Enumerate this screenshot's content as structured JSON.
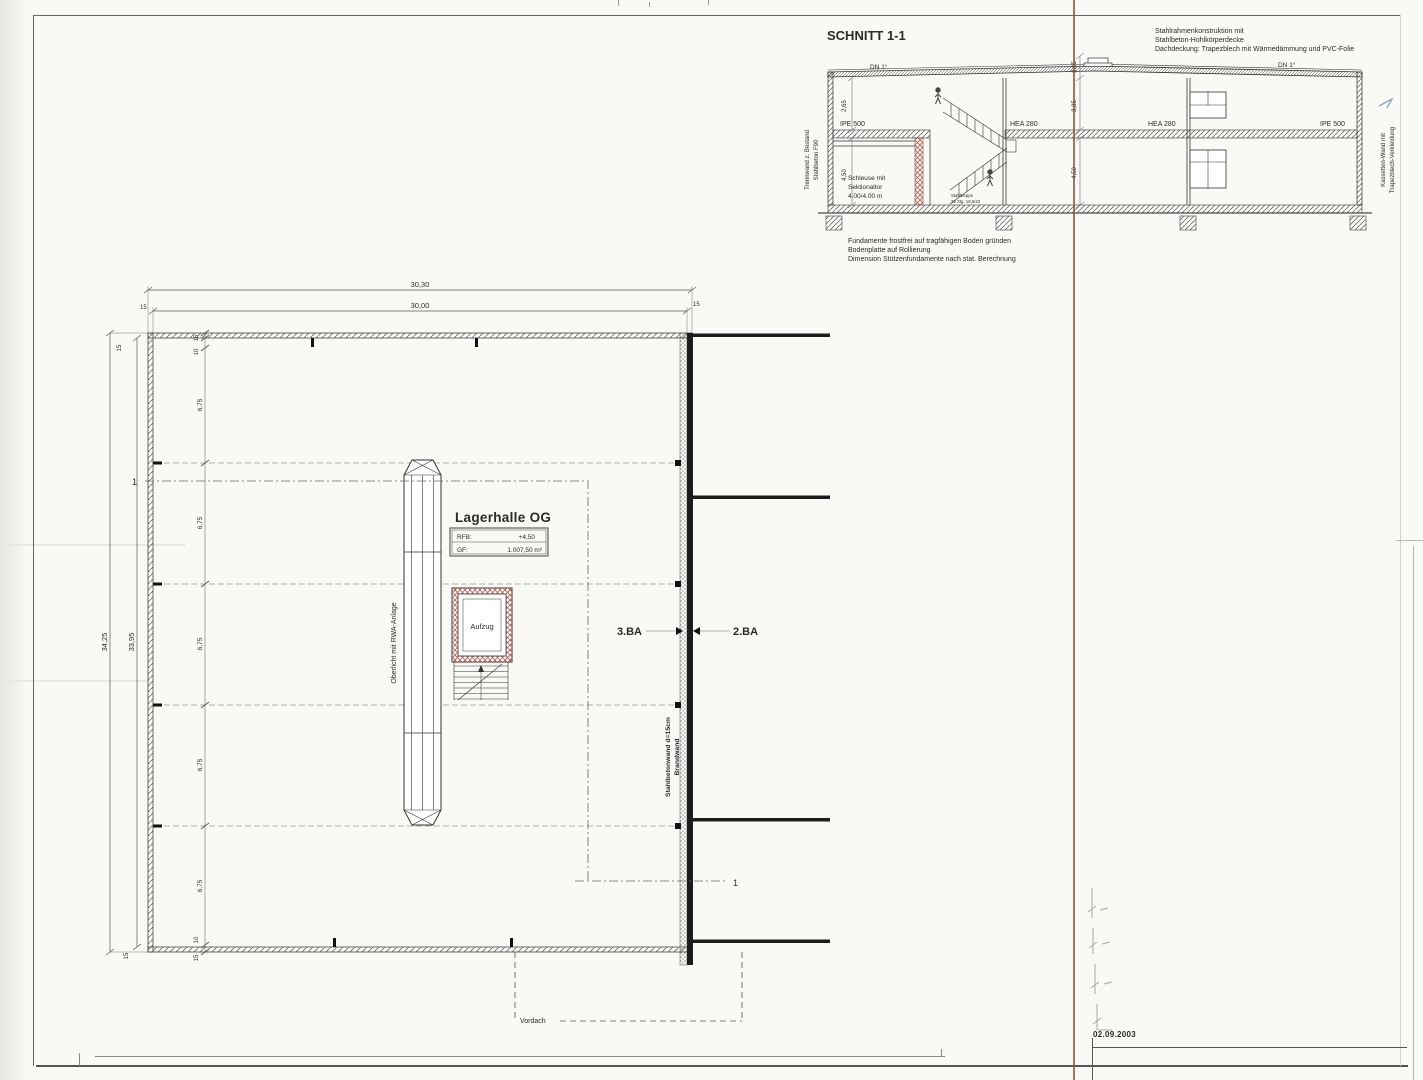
{
  "section": {
    "title": "SCHNITT 1-1",
    "notes_top": {
      "n1": "Stahlrahmenkonstruktion mit",
      "n2": "Stahlbeton-Hohlkörperdecke",
      "n3": "Dachdeckung:  Trapezblech mit Wärmedämmung und PVC-Folie"
    },
    "notes_bottom": {
      "n1": "Fundamente frostfrei auf tragfähigen Boden gründen",
      "n2": "Bodenplatte auf Rollierung",
      "n3": "Dimension Stützenfundamente nach stat. Berechnung"
    },
    "labels": {
      "dn": "DN 1°",
      "ipe": "IPE 500",
      "hea": "HEA 280",
      "d265": "2,65",
      "d450": "4,50",
      "d335": "3,35",
      "d305": "3,05",
      "schleuse1": "Schleuse mit",
      "schleuse2": "Sektionaltor",
      "schleuse3": "4.00/4.00 m",
      "treppe1": "Stahltreppe",
      "treppe2": "23 Stg. 18,5/23",
      "wleft1": "Trennwand z. Bestand",
      "wleft2": "Stahlbeton F90",
      "wright1": "Kassetten-Wand mit",
      "wright2": "Trapezblech-Verkleidung"
    }
  },
  "plan": {
    "title": "Lagerhalle OG",
    "info": {
      "rfb_label": "RFB:",
      "rfb_value": "+4,50",
      "gf_label": "GF:",
      "gf_value": "1.007,50 m²"
    },
    "dims": {
      "total_width": "30,30",
      "inner_width": "30,00",
      "total_height": "34,25",
      "inner_height": "33,95",
      "bay": "6,75",
      "wall15": "15",
      "off10": "10"
    },
    "labels": {
      "oberlicht": "Oberlicht mit RWA-Anlage",
      "aufzug": "Aufzug",
      "ba3": "3.BA",
      "ba2": "2.BA",
      "brandwand1": "Stahlbetonwand d=15cm",
      "brandwand2": "Brandwand",
      "vordach": "Vordach",
      "mark": "1"
    }
  },
  "footer": {
    "date": "02.09.2003"
  }
}
